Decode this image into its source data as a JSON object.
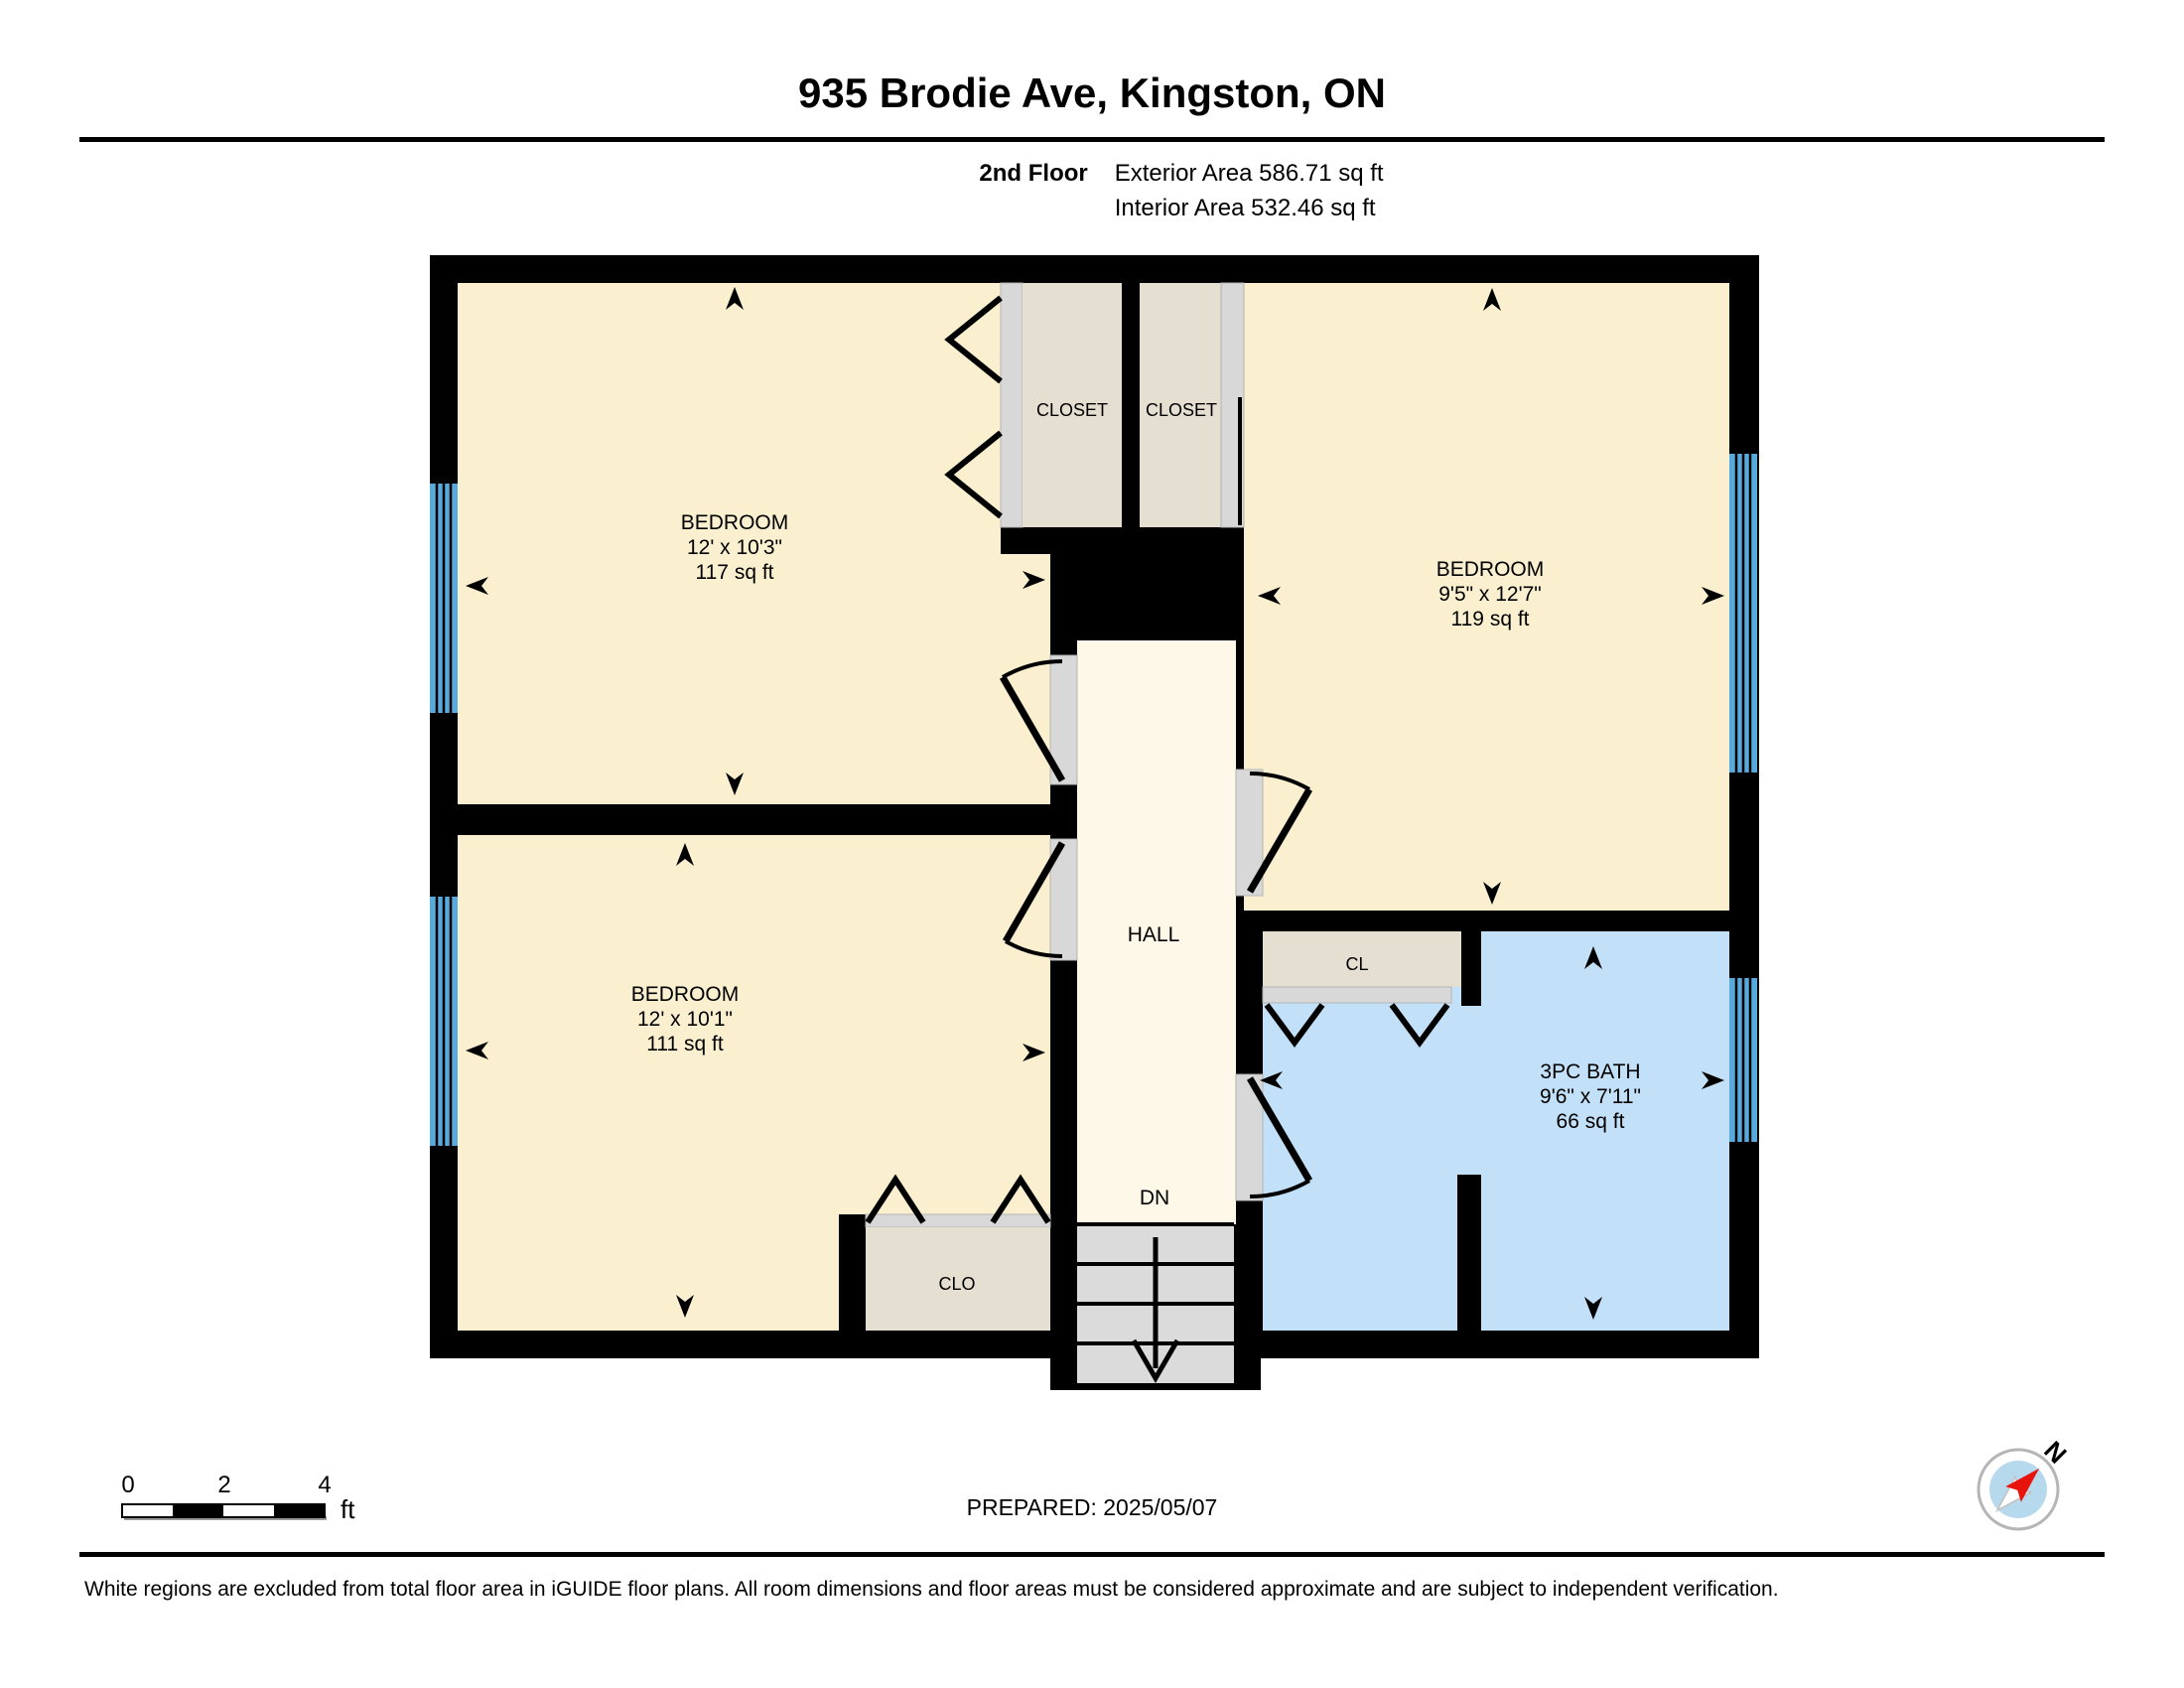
{
  "page": {
    "title": "935 Brodie Ave, Kingston, ON",
    "floor_label": "2nd Floor",
    "exterior_area": "Exterior Area 586.71 sq ft",
    "interior_area": "Interior Area 532.46 sq ft",
    "prepared": "PREPARED: 2025/05/07",
    "disclaimer": "White regions are excluded from total floor area in iGUIDE floor plans. All room dimensions and floor areas must be considered approximate and are subject to independent verification."
  },
  "rooms": {
    "bedroom_top_left": {
      "name": "BEDROOM",
      "dims": "12' x 10'3\"",
      "area": "117 sq ft"
    },
    "bedroom_bottom_left": {
      "name": "BEDROOM",
      "dims": "12' x 10'1\"",
      "area": "111 sq ft"
    },
    "bedroom_right": {
      "name": "BEDROOM",
      "dims": "9'5\" x 12'7\"",
      "area": "119 sq ft"
    },
    "bath": {
      "name": "3PC BATH",
      "dims": "9'6\" x 7'11\"",
      "area": "66 sq ft"
    },
    "closet_left": {
      "name": "CLOSET"
    },
    "closet_right": {
      "name": "CLOSET"
    },
    "closet_hall": {
      "name": "CL"
    },
    "closet_bedroom": {
      "name": "CLO"
    },
    "hall": {
      "name": "HALL"
    },
    "stairs": {
      "label": "DN"
    }
  },
  "scale_bar": {
    "tick0": "0",
    "tick1": "2",
    "tick2": "4",
    "unit": "ft"
  },
  "compass": {
    "north": "N"
  },
  "colors": {
    "wall": "#000000",
    "bedroom": "#faf0cf",
    "hall": "#fdf8e8",
    "closet": "#e5dfd1",
    "bath": "#c2e0f7",
    "window": "#58a9dc",
    "door": "#d8d8d8",
    "stairs": "#dbdbdb",
    "compass_inner": "#b7d9ee",
    "compass_needle": "#e8130b"
  }
}
